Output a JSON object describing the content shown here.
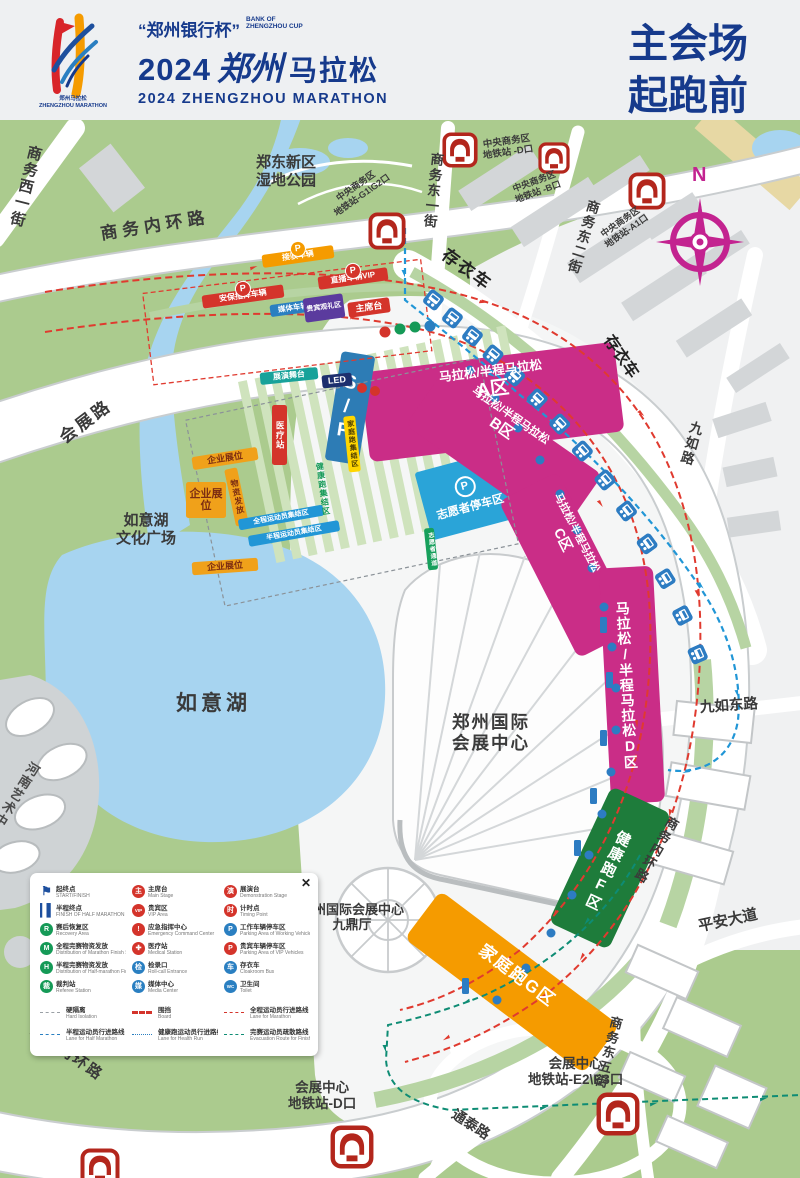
{
  "header": {
    "cup_cn": "“郑州银行杯”",
    "cup_en1": "BANK OF",
    "cup_en2": "ZHENGZHOU CUP",
    "year": "2024",
    "script": "郑州",
    "title_rest": "马拉松",
    "title_en": "2024 ZHENGZHOU MARATHON",
    "badge": "郑州马拉松\nZHENGZHOU MARATHON",
    "page_title": "主会场\n起跑前"
  },
  "map": {
    "compass_n": "N",
    "start_finish": "S/F",
    "roads": [
      {
        "label": "商务西一街"
      },
      {
        "label": "商务内环路"
      },
      {
        "label": "会展路"
      },
      {
        "label": "商务东一街"
      },
      {
        "label": "商务东二街"
      },
      {
        "label": "九如路"
      },
      {
        "label": "九如东路"
      },
      {
        "label": "平安大道"
      },
      {
        "label": "商务内环路"
      },
      {
        "label": "商务东五街"
      },
      {
        "label": "通泰路"
      },
      {
        "label": "商务内环路"
      }
    ],
    "places": [
      {
        "label": "郑东新区\n湿地公园"
      },
      {
        "label": "如意湖"
      },
      {
        "label": "如意湖\n文化广场"
      },
      {
        "label": "郑州国际\n会展中心"
      },
      {
        "label": "郑州国际会展中心\n九鼎厅"
      },
      {
        "label": "河南艺术中心"
      },
      {
        "label": "存衣车"
      },
      {
        "label": "存衣车"
      }
    ],
    "zones": [
      {
        "line1": "马拉松/半程马拉松",
        "line2": "A区"
      },
      {
        "line1": "马拉松/半程马拉松",
        "line2": "B区"
      },
      {
        "line1": "马拉松/半程马拉松",
        "line2": "C区"
      },
      {
        "label": "马拉松/半程马拉松D区"
      },
      {
        "label": "健康跑F区"
      },
      {
        "label": "家庭跑G区"
      }
    ],
    "metro_stations": [
      {
        "label": "中央商务区\n地铁站 -D口"
      },
      {
        "label": "中央商务区\n地铁站 -B口"
      },
      {
        "label": "中央商务区\n地铁站-A1口"
      },
      {
        "label": "中央商务区\n地铁站-G1\\G2口"
      },
      {
        "label": "会展中心\n地铁站-E2\\E3口"
      },
      {
        "label": "会展中心\n地铁站-D口"
      }
    ],
    "facilities": [
      {
        "label": "接驳车辆",
        "icon": "P"
      },
      {
        "label": "直播车辆VIP",
        "icon": "P"
      },
      {
        "label": "安保指挥车辆",
        "icon": "P"
      },
      {
        "label": "媒体车辆",
        "icon": "P"
      },
      {
        "label": "贵宾观礼区"
      },
      {
        "label": "主席台",
        "icon": "主"
      },
      {
        "label": "展演舞台"
      },
      {
        "label": "LED"
      },
      {
        "label": "志愿者停车区",
        "icon": "P"
      },
      {
        "label": "企业展位"
      },
      {
        "label": "企业展位"
      },
      {
        "label": "企业展位"
      },
      {
        "label": "物资发放"
      },
      {
        "label": "医疗站",
        "icon": "✚"
      },
      {
        "label": "全程运动员集结区"
      },
      {
        "label": "半程运动员集结区"
      },
      {
        "label": "健康跑集结区"
      },
      {
        "label": "家庭跑集结区"
      },
      {
        "label": "志愿者通道"
      }
    ]
  },
  "legend": {
    "close": "✕",
    "items": [
      {
        "cn": "起终点",
        "en": "START/FINISH",
        "icon": "⚑"
      },
      {
        "cn": "半程终点",
        "en": "FINISH OF HALF MARATHON",
        "icon": "▌▌"
      },
      {
        "cn": "赛后恢复区",
        "en": "Recovery Area",
        "icon": "R"
      },
      {
        "cn": "全程完赛物资发放",
        "en": "Distribution of Marathon Finish Supply",
        "icon": "M"
      },
      {
        "cn": "半程完赛物资发放",
        "en": "Distribution of Half-marathon Finish Supply",
        "icon": "H"
      },
      {
        "cn": "裁判站",
        "en": "Referee Station",
        "icon": "裁"
      },
      {
        "cn": "主席台",
        "en": "Main Stage",
        "icon": "主"
      },
      {
        "cn": "贵宾区",
        "en": "VIP Area",
        "icon": "VIP"
      },
      {
        "cn": "应急指挥中心",
        "en": "Emergency Command Center",
        "icon": "!"
      },
      {
        "cn": "医疗站",
        "en": "Medical Station",
        "icon": "✚"
      },
      {
        "cn": "检录口",
        "en": "Roll-call Entrance",
        "icon": "检"
      },
      {
        "cn": "媒体中心",
        "en": "Media Center",
        "icon": "媒"
      },
      {
        "cn": "展演台",
        "en": "Demonstration Stage",
        "icon": "演"
      },
      {
        "cn": "计时点",
        "en": "Timing Point",
        "icon": "时"
      },
      {
        "cn": "工作车辆停车区",
        "en": "Parking Area of Working Vehicles",
        "icon": "P"
      },
      {
        "cn": "贵宾车辆停车区",
        "en": "Parking Area of VIP Vehicles",
        "icon": "P"
      },
      {
        "cn": "存衣车",
        "en": "Cloakroom Bus",
        "icon": "车"
      },
      {
        "cn": "卫生间",
        "en": "Toilet",
        "icon": "WC"
      }
    ],
    "lines": [
      {
        "cn": "硬隔离",
        "en": "Hard Isolation"
      },
      {
        "cn": "围挡",
        "en": "Board"
      },
      {
        "cn": "全程运动员行进路线",
        "en": "Lane for Marathon"
      },
      {
        "cn": "半程运动员行进路线",
        "en": "Lane for Half Marathon"
      },
      {
        "cn": "健康跑运动员行进路线",
        "en": "Lane for Health Run"
      },
      {
        "cn": "完赛运动员疏散路线",
        "en": "Evacuation Route for Finishers"
      }
    ]
  },
  "colors": {
    "accent_blue": "#163a8c",
    "zone_magenta": "#ca2d87",
    "zone_green": "#1e7c3b",
    "zone_orange": "#f59b00",
    "route_red": "#e03a2f",
    "route_blue": "#2196d6",
    "route_teal": "#0e8c74",
    "metro_red": "#b3261c",
    "compass_magenta": "#c32390",
    "park_green": "#abcb8e",
    "water_blue": "#a7d4f0"
  }
}
